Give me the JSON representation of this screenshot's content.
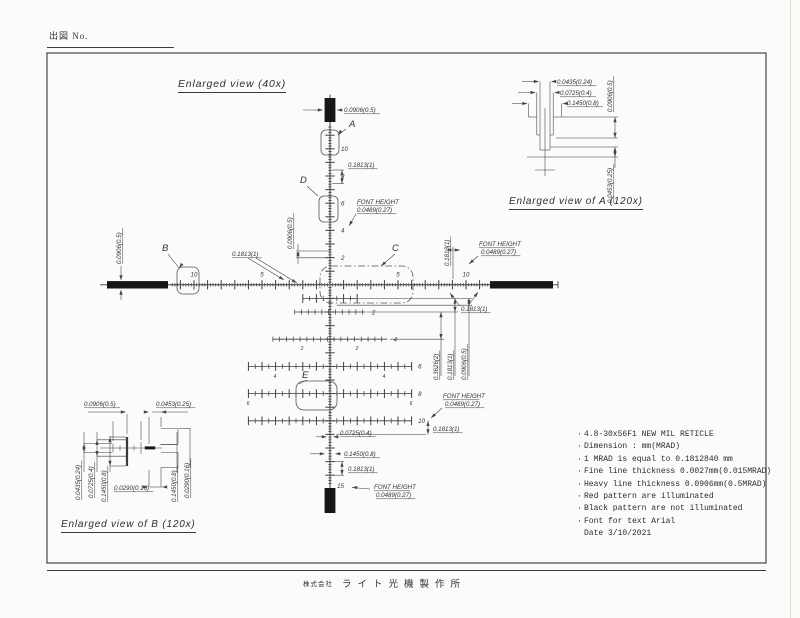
{
  "sheet": {
    "drawing_no_label": "出図 No.",
    "footer_company_prefix": "株式会社",
    "footer_company_name": "ライト光機製作所"
  },
  "titles": {
    "main": "Enlarged view (40x)",
    "detail_a": "Enlarged view of A (120x)",
    "detail_b": "Enlarged view of B (120x)"
  },
  "notes": {
    "bullet": "·",
    "items": [
      "4.8-30x56F1 NEW MIL RETICLE",
      "Dimension : mm(MRAD)",
      "1 MRAD is equal to 0.1812840 mm",
      "Fine line thickness 0.0027mm(0.015MRAD)",
      "Heavy line thickness 0.0906mm(0.5MRAD)",
      "Red pattern are illuminated",
      "Black pattern are not illuminated",
      "Font for text Arial"
    ],
    "date": "Date 3/10/2021"
  },
  "reticle": {
    "units": "mm(MRAD)",
    "center_x": 330,
    "center_y": 284.8,
    "px_per_mil": 13.6,
    "vertical_numbers": [
      "10",
      "8",
      "6",
      "4",
      "2"
    ],
    "horizontal_numbers": [
      {
        "t": "10",
        "mil": -10
      },
      {
        "t": "5",
        "mil": -5
      },
      {
        "t": "5",
        "mil": 5
      },
      {
        "t": "10",
        "mil": 10
      }
    ],
    "bottom_number": "15",
    "tree_rows": [
      {
        "mil": 1,
        "half": 2.0,
        "label": ""
      },
      {
        "mil": 2,
        "half": 2.6,
        "label": "2"
      },
      {
        "mil": 4,
        "half": 4.2,
        "label": "4"
      },
      {
        "mil": 6,
        "half": 6.0,
        "label": "6"
      },
      {
        "mil": 8,
        "half": 6.0,
        "label": "8"
      },
      {
        "mil": 10,
        "half": 6.0,
        "label": "10"
      }
    ],
    "sub_numbers": [
      {
        "t": "2",
        "x": 302,
        "y": 350
      },
      {
        "t": "2",
        "x": 357,
        "y": 350
      },
      {
        "t": "4",
        "x": 275,
        "y": 378
      },
      {
        "t": "4",
        "x": 384,
        "y": 378
      },
      {
        "t": "6",
        "x": 248,
        "y": 405
      },
      {
        "t": "6",
        "x": 411,
        "y": 405
      }
    ],
    "callouts": [
      {
        "t": "A",
        "x": 349,
        "y": 127
      },
      {
        "t": "B",
        "x": 162,
        "y": 251
      },
      {
        "t": "C",
        "x": 392,
        "y": 251
      },
      {
        "t": "D",
        "x": 300,
        "y": 183
      },
      {
        "t": "E",
        "x": 302,
        "y": 378
      }
    ],
    "dim_labels": [
      {
        "t": "0.0906(0.5)",
        "x": 344,
        "y": 112
      },
      {
        "t": "0.1813(1)",
        "x": 348,
        "y": 167
      },
      {
        "t": "FONT HEIGHT",
        "x": 357,
        "y": 204
      },
      {
        "t": "0.0489(0.27)",
        "x": 357,
        "y": 212
      },
      {
        "t": "0.0906(0.5)",
        "x": 292,
        "y": 249,
        "rot": true
      },
      {
        "t": "0.1813(1)",
        "x": 232,
        "y": 256
      },
      {
        "t": "0.0906(0.5)",
        "x": 121,
        "y": 264,
        "rot": true
      },
      {
        "t": "0.1813(1)",
        "x": 449,
        "y": 266,
        "rot": true
      },
      {
        "t": "FONT HEIGHT",
        "x": 479,
        "y": 246
      },
      {
        "t": "0.0489(0.27)",
        "x": 481,
        "y": 254
      },
      {
        "t": "0.1813(1)",
        "x": 461,
        "y": 311
      },
      {
        "t": "0.3626(2)",
        "x": 438,
        "y": 380,
        "rot": true
      },
      {
        "t": "0.1813(1)",
        "x": 452,
        "y": 380,
        "rot": true
      },
      {
        "t": "0.0906(0.5)",
        "x": 466,
        "y": 380,
        "rot": true
      },
      {
        "t": "FONT HEIGHT",
        "x": 443,
        "y": 398
      },
      {
        "t": "0.0489(0.27)",
        "x": 445,
        "y": 406
      },
      {
        "t": "0.1813(1)",
        "x": 433,
        "y": 431
      },
      {
        "t": "0.0725(0.4)",
        "x": 340,
        "y": 435
      },
      {
        "t": "0.1450(0.8)",
        "x": 344,
        "y": 456
      },
      {
        "t": "0.1813(1)",
        "x": 348,
        "y": 471
      },
      {
        "t": "FONT HEIGHT",
        "x": 374,
        "y": 489
      },
      {
        "t": "0.0489(0.27)",
        "x": 376,
        "y": 497
      },
      {
        "t": "0.0435(0.24)",
        "x": 557,
        "y": 84
      },
      {
        "t": "0.0725(0.4)",
        "x": 560,
        "y": 95
      },
      {
        "t": "0.1450(0.8)",
        "x": 567,
        "y": 105
      },
      {
        "t": "0.0906(0.5)",
        "x": 612,
        "y": 112,
        "rot": true
      },
      {
        "t": "0.0453(0.25)",
        "x": 612,
        "y": 203,
        "rot": true
      },
      {
        "t": "0.0906(0.5)",
        "x": 84,
        "y": 406
      },
      {
        "t": "0.0453(0.25)",
        "x": 156,
        "y": 406
      },
      {
        "t": "0.0435(0.24)",
        "x": 80,
        "y": 500,
        "rot": true
      },
      {
        "t": "0.0725(0.4)",
        "x": 93,
        "y": 498,
        "rot": true
      },
      {
        "t": "0.1450(0.8)",
        "x": 106,
        "y": 502,
        "rot": true
      },
      {
        "t": "0.0290(0.16)",
        "x": 114,
        "y": 490
      },
      {
        "t": "0.1450(0.8)",
        "x": 176,
        "y": 502,
        "rot": true
      },
      {
        "t": "0.0290(0.16)",
        "x": 189,
        "y": 498,
        "rot": true
      }
    ]
  }
}
